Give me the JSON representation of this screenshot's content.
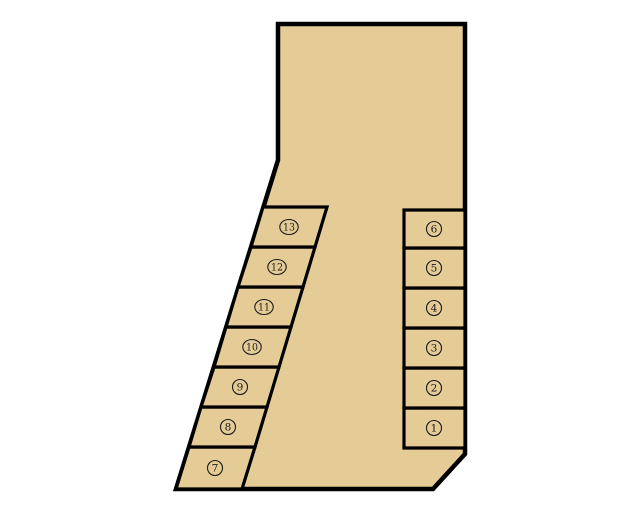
{
  "page": {
    "background": "#ffffff"
  },
  "diagram": {
    "name": "numbered-lot-layout",
    "width": 640,
    "height": 512,
    "colors": {
      "fill": "#e5cc96",
      "outline": "#000000",
      "label": "#1a1a1a"
    },
    "outline": {
      "points": "278,24 465,24 465,454 433,489 176,489 278,160",
      "stroke_width": 4.5
    },
    "cell_stroke_width": 3.2,
    "label_style": {
      "radius": 7.5,
      "two_digit_rx": 9.2,
      "font_size": 10.5,
      "circle_stroke": 1.1
    },
    "cells": [
      {
        "number": 1,
        "label": "1",
        "glyph": "①",
        "points": "404,408 465,408 465,448 404,448",
        "cx": 434,
        "cy": 428
      },
      {
        "number": 2,
        "label": "2",
        "glyph": "②",
        "points": "404,368 465,368 465,408 404,408",
        "cx": 434,
        "cy": 388
      },
      {
        "number": 3,
        "label": "3",
        "glyph": "③",
        "points": "404,328 465,328 465,368 404,368",
        "cx": 434,
        "cy": 348
      },
      {
        "number": 4,
        "label": "4",
        "glyph": "④",
        "points": "404,288 465,288 465,328 404,328",
        "cx": 434,
        "cy": 308
      },
      {
        "number": 5,
        "label": "5",
        "glyph": "⑤",
        "points": "404,248 465,248 465,288 404,288",
        "cx": 434,
        "cy": 268
      },
      {
        "number": 6,
        "label": "6",
        "glyph": "⑥",
        "points": "404,210 465,210 465,248 404,248",
        "cx": 434,
        "cy": 229
      },
      {
        "number": 7,
        "label": "7",
        "glyph": "⑦",
        "points": "189,447 255,447 242,489 176,489",
        "cx": 215,
        "cy": 468
      },
      {
        "number": 8,
        "label": "8",
        "glyph": "⑧",
        "points": "201,407 267,407 255,447 189,447",
        "cx": 228,
        "cy": 427
      },
      {
        "number": 9,
        "label": "9",
        "glyph": "⑨",
        "points": "214,367 279,367 267,407 201,407",
        "cx": 240,
        "cy": 387
      },
      {
        "number": 10,
        "label": "10",
        "glyph": "⑩",
        "points": "226,327 291,327 279,367 214,367",
        "cx": 252,
        "cy": 347
      },
      {
        "number": 11,
        "label": "11",
        "glyph": "⑪",
        "points": "238,287 303,287 291,327 226,327",
        "cx": 264,
        "cy": 307
      },
      {
        "number": 12,
        "label": "12",
        "glyph": "⑫",
        "points": "251,247 315,247 303,287 238,287",
        "cx": 277,
        "cy": 267
      },
      {
        "number": 13,
        "label": "13",
        "glyph": "⑬",
        "points": "263,207 327,207 315,247 251,247",
        "cx": 289,
        "cy": 227
      }
    ]
  }
}
